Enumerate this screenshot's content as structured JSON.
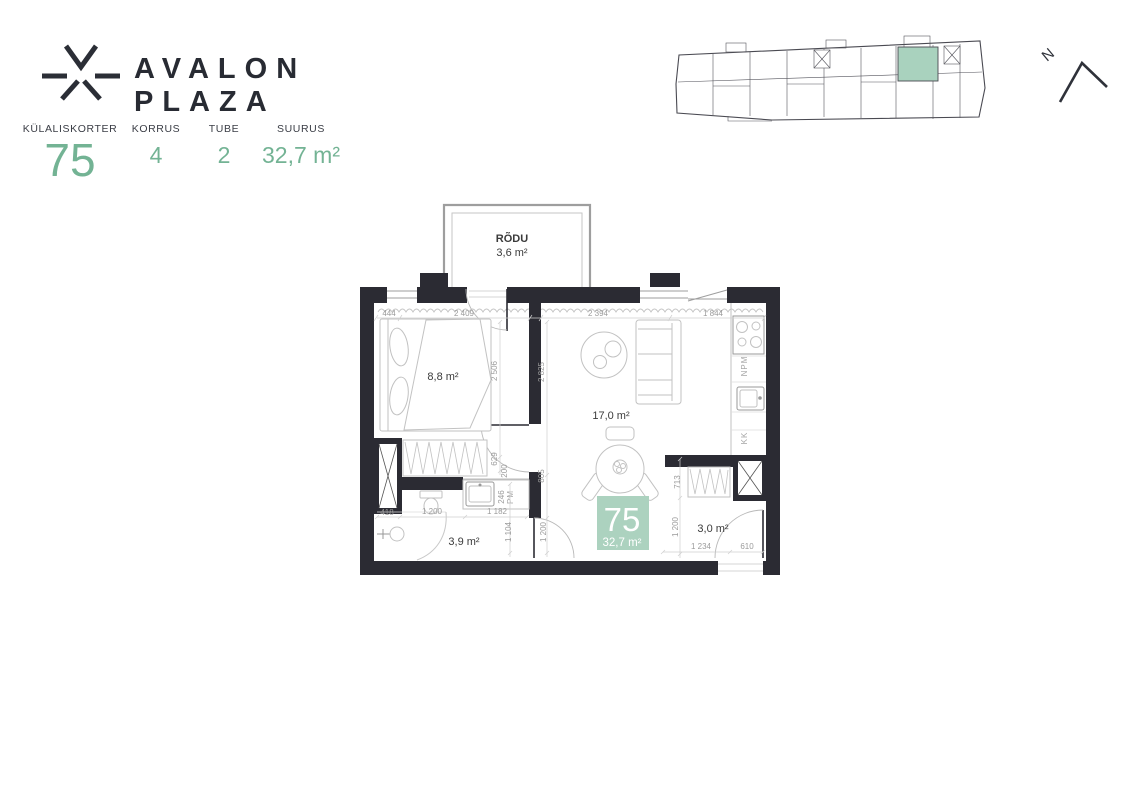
{
  "header": {
    "brand": "AVALON PLAZA",
    "stats": [
      {
        "label": "KÜLALISKORTER",
        "value": "75"
      },
      {
        "label": "KORRUS",
        "value": "4"
      },
      {
        "label": "TUBE",
        "value": "2"
      },
      {
        "label": "SUURUS",
        "value": "32,7 m²"
      }
    ]
  },
  "north": {
    "label": "N"
  },
  "colors": {
    "accent_green": "#73b394",
    "badge_green": "#acd2bf",
    "map_unit_green": "#a9d2be",
    "wall_dark": "#2b2b33"
  },
  "plan": {
    "balcony": {
      "name": "RÕDU",
      "area": "3,6 m²"
    },
    "rooms": {
      "bedroom": {
        "area": "8,8 m²"
      },
      "living": {
        "area": "17,0 m²"
      },
      "bathroom": {
        "area": "3,9 m²"
      },
      "hall": {
        "area": "3,0 m²"
      }
    },
    "badge": {
      "number": "75",
      "area": "32,7 m²"
    },
    "appliances": {
      "dishwasher": "NPM",
      "fridge": "KK",
      "washer": "PM"
    },
    "dims": {
      "d444": "444",
      "d2409": "2 409",
      "d2394": "2 394",
      "d1844": "1 844",
      "d2506": "2 506",
      "d2825": "2 825",
      "d629": "629",
      "d200": "200",
      "d805": "805",
      "d246": "246",
      "d1104": "1 104",
      "d1200_bath": "1 200",
      "d713": "713",
      "d1200_hall": "1 200",
      "d418": "418",
      "d1200_bottom": "1 200",
      "d1182": "1 182",
      "d1234": "1 234",
      "d610": "610"
    }
  }
}
